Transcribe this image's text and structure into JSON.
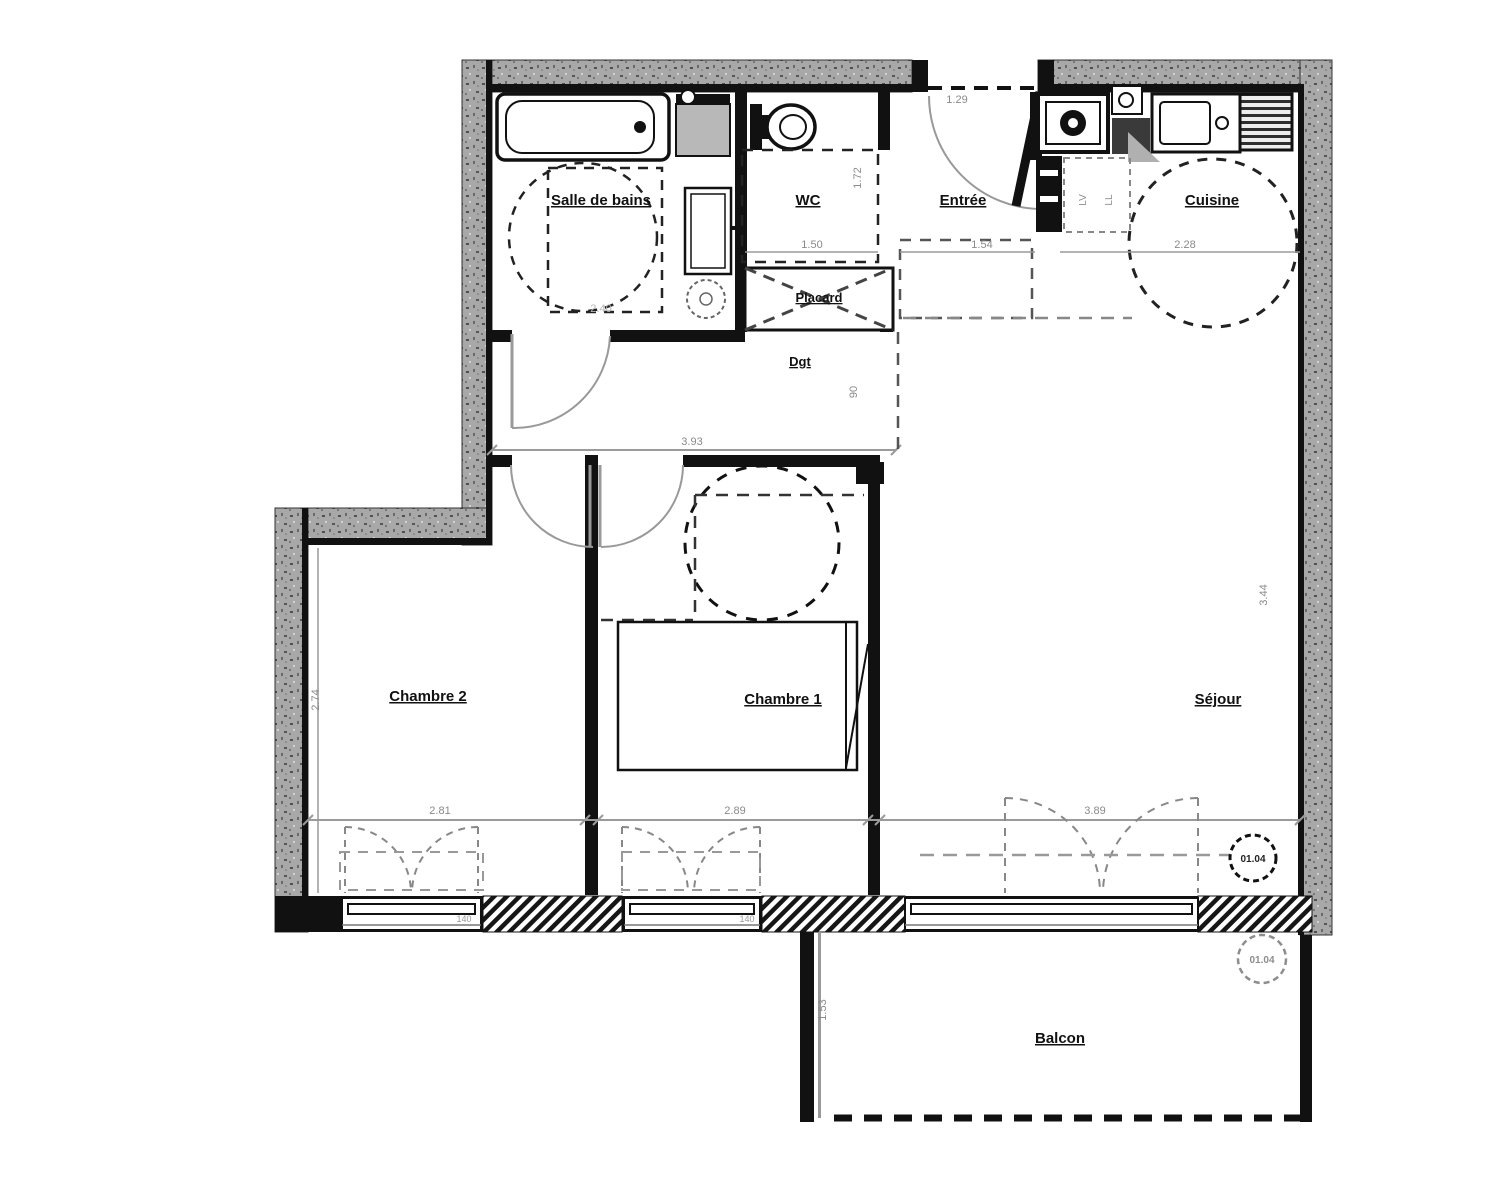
{
  "plan": {
    "rooms": {
      "salle_de_bains": "Salle de bains",
      "wc": "WC",
      "entree": "Entrée",
      "cuisine": "Cuisine",
      "placard": "Placard",
      "dgt": "Dgt",
      "chambre2": "Chambre 2",
      "chambre1": "Chambre 1",
      "sejour": "Séjour",
      "balcon": "Balcon"
    },
    "dims": {
      "entree_top": "1.29",
      "wc_h": "1.72",
      "wc_w": "1.50",
      "entree_w": "1.54",
      "cuisine_w": "2.28",
      "sdb_w": "2.40",
      "dgt_w": "3.93",
      "dgt_door": "90",
      "ch2_h": "2.74",
      "ch2_w": "2.81",
      "ch1_w": "2.89",
      "sejour_w": "3.89",
      "sejour_h": "3.44",
      "balcon_h": "1.53",
      "win_ch2": "140",
      "win_ch1": "140"
    },
    "badges": {
      "unit": "01.04",
      "unit_balcony": "01.04"
    },
    "appliances": {
      "lv": "LV",
      "ll": "LL"
    }
  }
}
